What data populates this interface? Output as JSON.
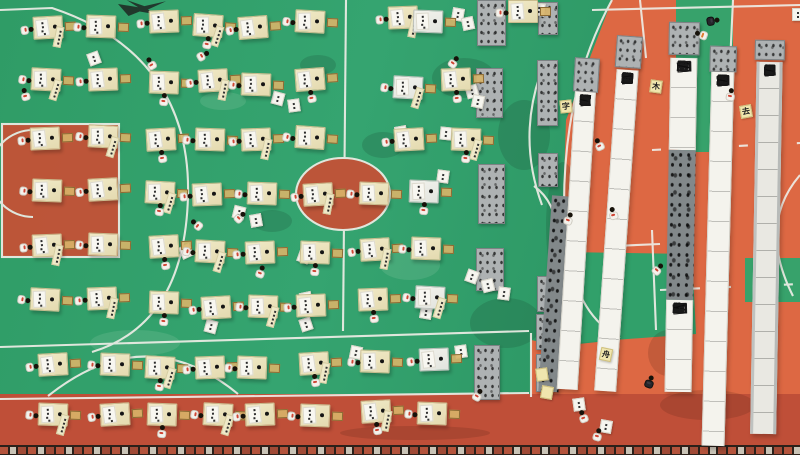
{
  "scene": {
    "description": "Aerial drone view of a school basketball court: students at yellow desks writing calligraphy; long banner scrolls with Chinese characters laid out on the right side of the court."
  },
  "palette": {
    "court_green": "#2f9c66",
    "court_orange": "#dd6843",
    "track_red": "#bf4f38",
    "key_red": "#c84f35",
    "line_white": "#eeede6",
    "desk_yellow": "#ece4bf",
    "stone_gray": "#aeb2b3",
    "banner_white": "#f4f3ed",
    "accent_red": "#cf4534"
  },
  "banners": [
    {
      "x": 552,
      "w": 20,
      "rot": 4,
      "segs": [
        {
          "y": 196,
          "h": 196,
          "style": "dark",
          "chars": ""
        }
      ]
    },
    {
      "x": 577,
      "w": 21,
      "rot": 3.5,
      "table": {
        "y": 58,
        "h": 34
      },
      "segs": [
        {
          "y": 92,
          "h": 298,
          "style": "white",
          "chars": "誰盤曉迴舟誂帝記年日孫沉醉不知歸興盡曉說"
        }
      ]
    },
    {
      "x": 619,
      "w": 22,
      "rot": 4,
      "table": {
        "y": 36,
        "h": 32
      },
      "segs": [
        {
          "y": 70,
          "h": 322,
          "style": "white",
          "chars": "住泰和萬千上遷南江到若去歸君送又緣春送始才滿盤盡"
        }
      ]
    },
    {
      "x": 671,
      "w": 27,
      "rot": 1,
      "table": {
        "y": 22,
        "h": 33
      },
      "segs": [
        {
          "y": 58,
          "h": 92,
          "style": "white",
          "chars": "紫懷張卆寺天至"
        },
        {
          "y": 150,
          "h": 150,
          "style": "dark",
          "chars": ""
        },
        {
          "y": 300,
          "h": 92,
          "style": "white",
          "chars": "本亦民悞張卆"
        }
      ]
    },
    {
      "x": 712,
      "w": 23,
      "rot": 1.5,
      "table": {
        "y": 46,
        "h": 26
      },
      "segs": [
        {
          "y": 72,
          "h": 374,
          "style": "white",
          "chars": "不适依燈與月時夜元年仐後昏黃約人頭桃符村到月畫如燈市"
        }
      ]
    },
    {
      "x": 757,
      "w": 26,
      "rot": 1,
      "table": {
        "y": 40,
        "h": 20
      },
      "segs": [
        {
          "y": 62,
          "h": 372,
          "style": "grayw",
          "chars": "寶玉長擘流塵爭柯百透碧江漫染盤林風遍紅山萬香歸"
        }
      ]
    }
  ],
  "stone_tables": [
    [
      477,
      0,
      29,
      46
    ],
    [
      476,
      68,
      27,
      50
    ],
    [
      478,
      164,
      27,
      60
    ],
    [
      476,
      248,
      28,
      43
    ],
    [
      474,
      345,
      26,
      55
    ],
    [
      538,
      2,
      20,
      33
    ],
    [
      537,
      60,
      21,
      66
    ],
    [
      538,
      153,
      20,
      34
    ],
    [
      537,
      276,
      21,
      36
    ],
    [
      536,
      314,
      22,
      36
    ],
    [
      536,
      354,
      22,
      38
    ]
  ],
  "desks": [
    [
      48,
      28,
      0,
      -3,
      0
    ],
    [
      101,
      27,
      0,
      2,
      0
    ],
    [
      164,
      22,
      0,
      -2,
      0
    ],
    [
      208,
      26,
      0,
      4,
      3
    ],
    [
      253,
      28,
      0,
      -4,
      0
    ],
    [
      310,
      22,
      0,
      3,
      0
    ],
    [
      403,
      18,
      0,
      -2,
      0
    ],
    [
      428,
      22,
      1,
      2,
      4
    ],
    [
      523,
      12,
      0,
      0,
      0
    ],
    [
      46,
      80,
      0,
      3,
      0
    ],
    [
      103,
      80,
      0,
      -2,
      0
    ],
    [
      164,
      83,
      0,
      2,
      3
    ],
    [
      213,
      81,
      0,
      -3,
      0
    ],
    [
      256,
      85,
      0,
      2,
      0
    ],
    [
      310,
      80,
      0,
      -4,
      3
    ],
    [
      408,
      88,
      1,
      3,
      0
    ],
    [
      456,
      80,
      0,
      -2,
      3
    ],
    [
      45,
      139,
      0,
      -2,
      0
    ],
    [
      103,
      137,
      0,
      3,
      0
    ],
    [
      161,
      140,
      0,
      -3,
      3
    ],
    [
      210,
      140,
      0,
      2,
      0
    ],
    [
      256,
      140,
      0,
      -2,
      0
    ],
    [
      310,
      138,
      0,
      4,
      0
    ],
    [
      409,
      140,
      0,
      -3,
      0
    ],
    [
      466,
      140,
      0,
      2,
      3
    ],
    [
      47,
      191,
      0,
      2,
      0
    ],
    [
      103,
      190,
      0,
      -3,
      0
    ],
    [
      160,
      193,
      0,
      3,
      3
    ],
    [
      207,
      195,
      0,
      -2,
      0
    ],
    [
      262,
      194,
      0,
      2,
      0
    ],
    [
      318,
      195,
      0,
      -3,
      0
    ],
    [
      374,
      194,
      0,
      2,
      0
    ],
    [
      424,
      192,
      1,
      2,
      3
    ],
    [
      47,
      246,
      0,
      -2,
      0
    ],
    [
      103,
      245,
      0,
      2,
      0
    ],
    [
      164,
      247,
      0,
      -3,
      3
    ],
    [
      210,
      252,
      0,
      3,
      0
    ],
    [
      260,
      253,
      0,
      -2,
      0
    ],
    [
      315,
      253,
      0,
      2,
      3
    ],
    [
      375,
      250,
      0,
      -3,
      0
    ],
    [
      426,
      249,
      0,
      2,
      0
    ],
    [
      45,
      300,
      0,
      3,
      0
    ],
    [
      102,
      299,
      0,
      -2,
      0
    ],
    [
      164,
      303,
      0,
      2,
      3
    ],
    [
      216,
      308,
      0,
      -3,
      0
    ],
    [
      263,
      307,
      0,
      2,
      0
    ],
    [
      311,
      306,
      0,
      -2,
      0
    ],
    [
      373,
      300,
      0,
      -2,
      3
    ],
    [
      430,
      298,
      1,
      3,
      0
    ],
    [
      53,
      365,
      0,
      -3,
      0
    ],
    [
      115,
      365,
      0,
      2,
      0
    ],
    [
      160,
      368,
      0,
      3,
      3
    ],
    [
      210,
      368,
      0,
      -2,
      0
    ],
    [
      252,
      368,
      0,
      2,
      0
    ],
    [
      314,
      364,
      0,
      -3,
      3
    ],
    [
      375,
      362,
      0,
      2,
      0
    ],
    [
      434,
      360,
      1,
      -2,
      0
    ],
    [
      53,
      415,
      0,
      2,
      0
    ],
    [
      115,
      415,
      0,
      -3,
      0
    ],
    [
      162,
      415,
      0,
      2,
      3
    ],
    [
      218,
      415,
      0,
      3,
      0
    ],
    [
      260,
      415,
      0,
      -2,
      0
    ],
    [
      315,
      416,
      0,
      2,
      0
    ],
    [
      376,
      412,
      0,
      -3,
      3
    ],
    [
      432,
      414,
      0,
      2,
      0
    ]
  ],
  "people": [
    [
      707,
      13,
      "dark",
      80
    ],
    [
      697,
      28,
      "lightr",
      -70
    ],
    [
      563,
      212,
      "light",
      20
    ],
    [
      608,
      207,
      "light",
      -15
    ],
    [
      725,
      88,
      "light",
      10
    ],
    [
      472,
      388,
      "light",
      30
    ],
    [
      578,
      410,
      "light",
      -20
    ],
    [
      592,
      428,
      "light",
      15
    ],
    [
      197,
      48,
      "light",
      60
    ],
    [
      146,
      57,
      "light",
      -30
    ],
    [
      234,
      210,
      "light",
      45
    ],
    [
      192,
      218,
      "light",
      -50
    ],
    [
      255,
      265,
      "light",
      20
    ],
    [
      20,
      88,
      "light",
      -15
    ],
    [
      448,
      55,
      "light",
      35
    ],
    [
      594,
      138,
      "light",
      -25
    ],
    [
      652,
      262,
      "light",
      40
    ],
    [
      644,
      375,
      "dark",
      20
    ]
  ],
  "papers": [
    [
      88,
      52,
      -20,
      "w",
      ""
    ],
    [
      272,
      92,
      15,
      "w",
      ""
    ],
    [
      288,
      99,
      -8,
      "w",
      ""
    ],
    [
      452,
      8,
      10,
      "w",
      ""
    ],
    [
      462,
      17,
      -12,
      "w",
      ""
    ],
    [
      455,
      75,
      8,
      "w",
      ""
    ],
    [
      466,
      85,
      -15,
      "w",
      ""
    ],
    [
      472,
      95,
      12,
      "w",
      ""
    ],
    [
      395,
      126,
      -10,
      "w",
      ""
    ],
    [
      440,
      127,
      6,
      "w",
      ""
    ],
    [
      233,
      206,
      14,
      "w",
      ""
    ],
    [
      250,
      214,
      -10,
      "w",
      ""
    ],
    [
      437,
      170,
      8,
      "w",
      ""
    ],
    [
      300,
      292,
      -12,
      "w",
      ""
    ],
    [
      420,
      306,
      10,
      "w",
      ""
    ],
    [
      455,
      345,
      -8,
      "w",
      ""
    ],
    [
      350,
      346,
      12,
      "w",
      ""
    ],
    [
      466,
      270,
      20,
      "w",
      ""
    ],
    [
      482,
      279,
      -14,
      "w",
      ""
    ],
    [
      498,
      287,
      8,
      "w",
      ""
    ],
    [
      180,
      245,
      -25,
      "w",
      ""
    ],
    [
      298,
      250,
      20,
      "w",
      ""
    ],
    [
      205,
      320,
      15,
      "w",
      ""
    ],
    [
      300,
      318,
      -18,
      "w",
      ""
    ],
    [
      573,
      398,
      -8,
      "w",
      ""
    ],
    [
      600,
      420,
      10,
      "w",
      ""
    ],
    [
      792,
      8,
      0,
      "w",
      ""
    ],
    [
      533,
      3,
      8,
      "w",
      ""
    ],
    [
      560,
      100,
      -6,
      "y",
      "字"
    ],
    [
      650,
      80,
      8,
      "y",
      "木"
    ],
    [
      740,
      105,
      -10,
      "y",
      "去"
    ],
    [
      600,
      348,
      12,
      "y",
      "舟"
    ],
    [
      536,
      368,
      -8,
      "y",
      ""
    ],
    [
      541,
      386,
      10,
      "y",
      ""
    ]
  ],
  "stains": [
    [
      432,
      58,
      64,
      40,
      "d"
    ],
    [
      498,
      100,
      52,
      70,
      "d"
    ],
    [
      362,
      132,
      42,
      26,
      "d"
    ],
    [
      546,
      162,
      34,
      128,
      "d"
    ],
    [
      300,
      55,
      36,
      20,
      "d"
    ],
    [
      470,
      298,
      72,
      50,
      "d"
    ],
    [
      252,
      210,
      40,
      22,
      "d"
    ],
    [
      660,
      390,
      95,
      30,
      "r"
    ],
    [
      340,
      426,
      150,
      14,
      "r"
    ],
    [
      648,
      330,
      40,
      46,
      "r"
    ],
    [
      90,
      330,
      90,
      26,
      "l"
    ],
    [
      200,
      92,
      46,
      18,
      "l"
    ],
    [
      380,
      250,
      60,
      30,
      "l"
    ]
  ],
  "green_patches": [
    [
      676,
      0,
      57,
      62
    ],
    [
      678,
      62,
      36,
      90
    ],
    [
      745,
      258,
      55,
      44
    ]
  ]
}
